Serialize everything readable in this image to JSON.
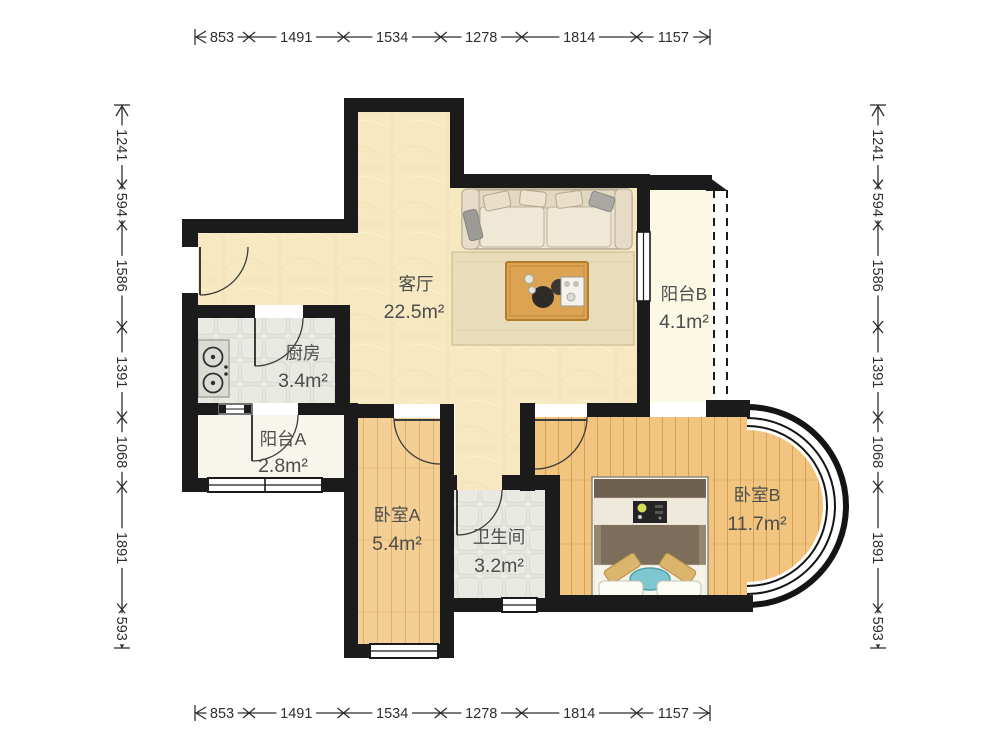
{
  "floor_plan": {
    "rooms": {
      "living_room": {
        "name": "客厅",
        "area": "22.5m²"
      },
      "kitchen": {
        "name": "厨房",
        "area": "3.4m²"
      },
      "balcony_a": {
        "name": "阳台A",
        "area": "2.8m²"
      },
      "balcony_b": {
        "name": "阳台B",
        "area": "4.1m²"
      },
      "bedroom_a": {
        "name": "卧室A",
        "area": "5.4m²"
      },
      "bedroom_b": {
        "name": "卧室B",
        "area": "11.7m²"
      },
      "bathroom": {
        "name": "卫生间",
        "area": "3.2m²"
      }
    },
    "dimensions_mm": {
      "top": [
        "853",
        "1491",
        "1534",
        "1278",
        "1814",
        "1157"
      ],
      "bottom": [
        "853",
        "1491",
        "1534",
        "1278",
        "1814",
        "1157"
      ],
      "left": [
        "1241",
        "594",
        "1586",
        "1391",
        "1068",
        "1891",
        "593"
      ],
      "right": [
        "1241",
        "594",
        "1586",
        "1391",
        "1068",
        "1891",
        "593"
      ]
    },
    "colors": {
      "wall": "#1b1b1b",
      "living_floor": "#f7e8c2",
      "bedroom_a_floor": "#f3cf96",
      "bedroom_b_floor": "#f1c57f",
      "tile_floor": "#e9e9e3",
      "balcony_a_floor": "#f7f5ec",
      "balcony_b_floor": "#fbf8e4",
      "rug": "#e8dcba",
      "coffee_table": "#dca353",
      "bed_duvet": "#7c6e5a",
      "bed_accent_pillow": "#7fc7d0",
      "dimension_text": "#2e2e2e",
      "room_label_text": "#4d4d4d"
    }
  }
}
